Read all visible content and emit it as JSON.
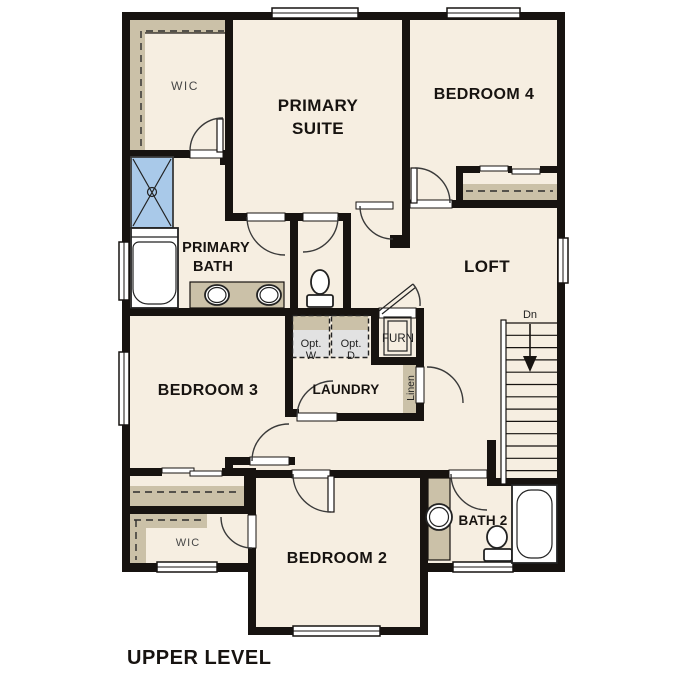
{
  "title": "UPPER LEVEL",
  "colors": {
    "wall": "#171310",
    "floor": "#f6eee1",
    "background": "#ffffff",
    "shelf_tan": "#cbc1a8",
    "fixture_blue": "#a9c9e9",
    "fixture_blue_light": "#d8e6f4",
    "appliance_gray": "#e2e2e2",
    "label_black": "#171310",
    "label_gray": "#474747"
  },
  "rooms": {
    "wic_upper": "WIC",
    "primary_suite_line1": "PRIMARY",
    "primary_suite_line2": "SUITE",
    "bedroom4": "BEDROOM 4",
    "primary_bath_line1": "PRIMARY",
    "primary_bath_line2": "BATH",
    "loft": "LOFT",
    "bedroom3": "BEDROOM 3",
    "laundry": "LAUNDRY",
    "wic_lower": "WIC",
    "bedroom2": "BEDROOM 2",
    "bath2": "BATH 2"
  },
  "annotations": {
    "stairs_direction": "Dn",
    "opt_washer_line1": "Opt.",
    "opt_washer_line2": "W",
    "opt_dryer_line1": "Opt.",
    "opt_dryer_line2": "D",
    "furnace": "FURN",
    "linen": "Linen"
  }
}
